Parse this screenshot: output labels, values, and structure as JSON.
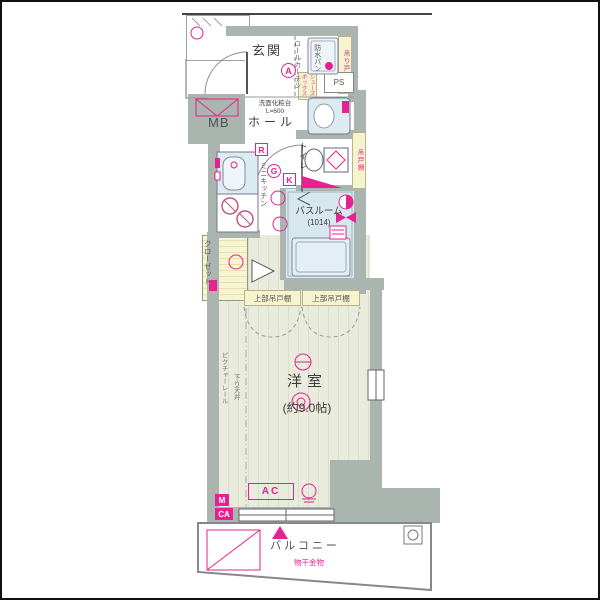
{
  "plan_type": "apartment-floor-plan",
  "colors": {
    "accent_pink": "#e5228f",
    "wall_gray": "#a9b5ae",
    "bath_blue": "#d7e7ee",
    "room_beige": "#e9ecdc",
    "cabinet_yellow": "#f6f3cf"
  },
  "labels": {
    "genkan": "玄関",
    "genkan_mark": "A",
    "roll_curtain": "ロールカーテン",
    "waterproof_pan": "防水パン",
    "hanging_shelf_laundry": "吊り戸棚",
    "ps": "PS",
    "shoe_box": "シューズボックス",
    "mb": "MB",
    "vanity_line1": "洗面化粧台",
    "vanity_line2": "L=600",
    "hall": "ホール",
    "toilet": "トイレ",
    "hanging_shelf_toilet": "吊戸棚",
    "mark_r": "R",
    "mark_g": "G",
    "mark_k": "K",
    "mini_kitchen": "ミニキッチン",
    "closet": "クローゼット",
    "bathroom": "バスルーム",
    "bathroom_size": "(1014)",
    "upper_cabinet": "上部吊戸棚",
    "room": "洋室",
    "room_size": "(約9.0帖)",
    "picture_rail": "ピクチャーレール",
    "lowered_ceiling": "下り天井",
    "ac": "AC",
    "outlet_m": "M",
    "outlet_ca": "CA",
    "balcony": "バルコニー",
    "drying_hardware": "物干金物"
  }
}
